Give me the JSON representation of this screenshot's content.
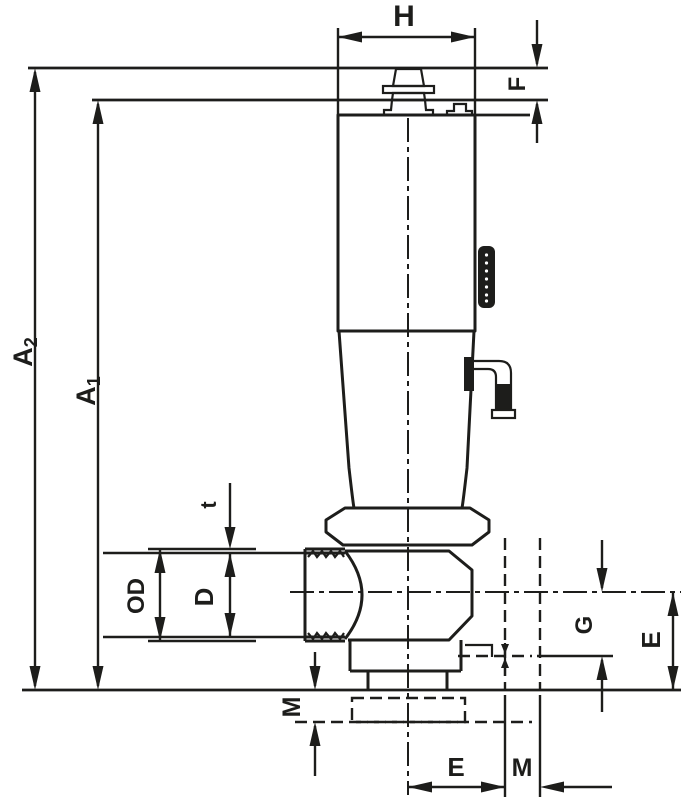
{
  "colors": {
    "line": "#1d1d1b",
    "background": "#ffffff"
  },
  "dimensions": {
    "h": {
      "label": "H"
    },
    "f": {
      "label": "F"
    },
    "a2": {
      "base": "A",
      "sub": "2"
    },
    "a1": {
      "base": "A",
      "sub": "1"
    },
    "t": {
      "label": "t"
    },
    "od": {
      "label": "OD"
    },
    "d": {
      "label": "D"
    },
    "m_left": {
      "label": "M"
    },
    "e_bottom": {
      "label": "E"
    },
    "m_bottom": {
      "label": "M"
    },
    "g": {
      "label": "G"
    },
    "e_right": {
      "label": "E"
    }
  }
}
